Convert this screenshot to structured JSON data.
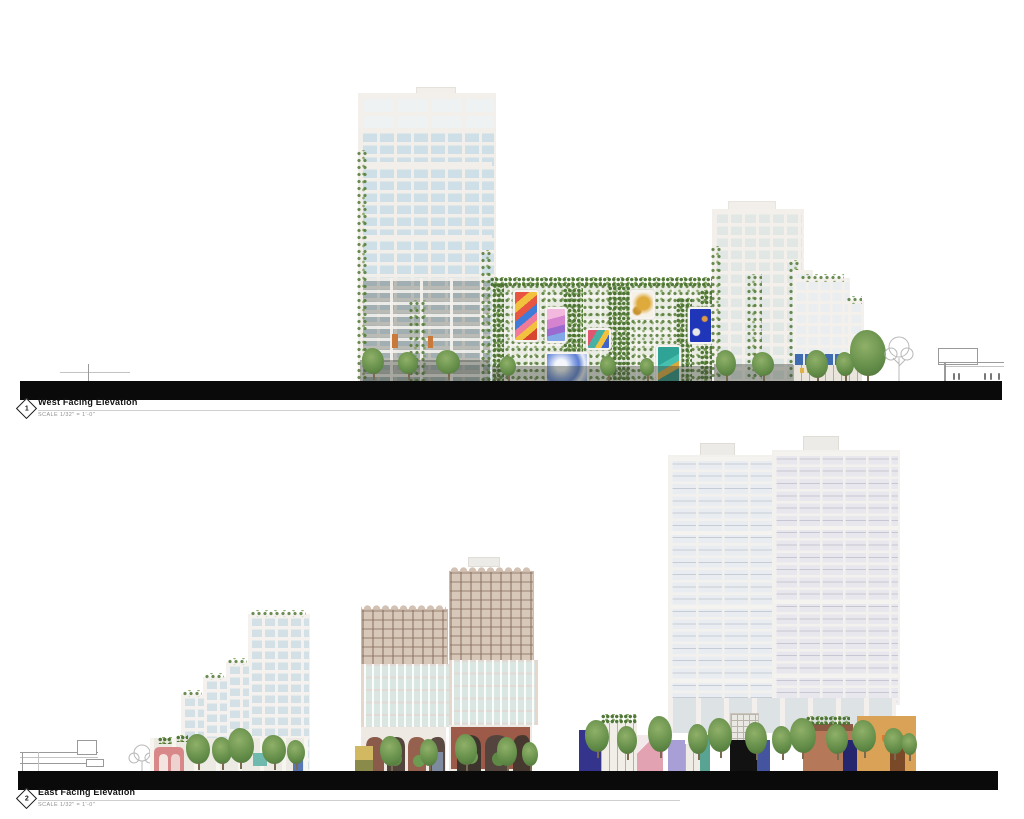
{
  "drawings": [
    {
      "number": "1",
      "title": "West Facing Elevation",
      "scale_note": "SCALE  1/32\" = 1'-0\""
    },
    {
      "number": "2",
      "title": "East Facing Elevation",
      "scale_note": "SCALE  1/32\" = 1'-0\""
    }
  ],
  "palette": {
    "ground_line": "#0a0a0a",
    "frame_white": "#f2efeb",
    "glass_blue": "#cfdfe7",
    "vegetation_green": "#628c48",
    "crown_beige": "#d8c8ba",
    "brick_red": "#9e5a48",
    "accent_blue_band": "#3f6cb0",
    "mural_colors": [
      "#e85540",
      "#d583cf",
      "#e0566e",
      "#dfaa3c",
      "#2036b8",
      "#7a9be0",
      "#2fa396"
    ],
    "street_building_colors": [
      "#34348c",
      "#eab0bc",
      "#a89fd6",
      "#58a392",
      "#44549e",
      "#b5795a",
      "#d9a257"
    ]
  }
}
